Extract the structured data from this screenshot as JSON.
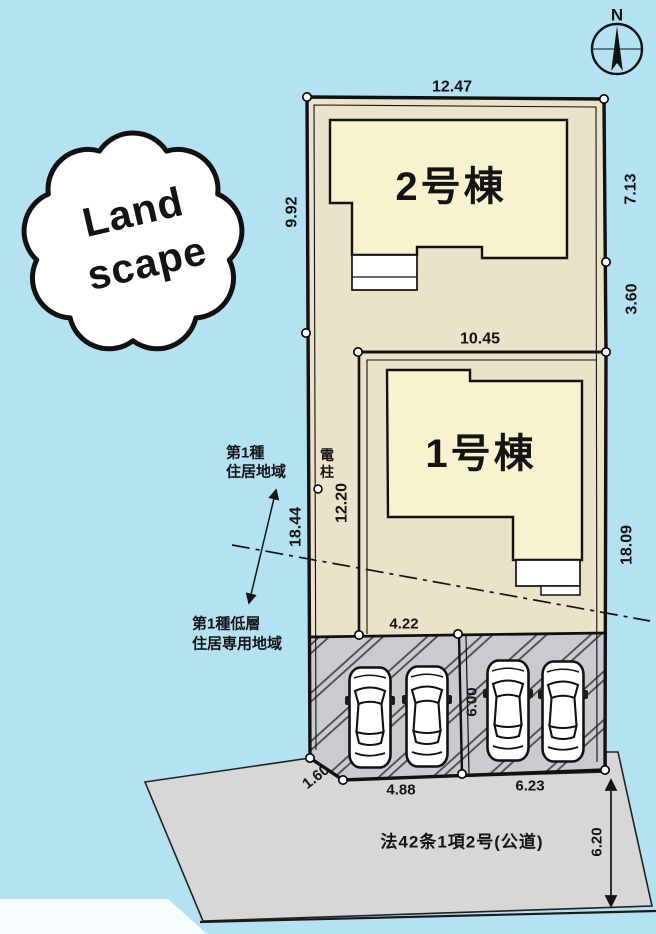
{
  "compass": {
    "north": "N"
  },
  "stamp": {
    "line1": "Land",
    "line2": "scape"
  },
  "buildings": {
    "b2": "2号棟",
    "b1": "1号棟"
  },
  "dims": {
    "top_width": "12.47",
    "left_upper": "9.92",
    "right_upper": "7.13",
    "right_mid": "3.60",
    "parcel1_top": "10.45",
    "parcel1_left": "12.20",
    "left_lower": "18.44",
    "right_lower": "18.09",
    "parcel1_bottom": "4.22",
    "parking_depth": "6.00",
    "corner_cut": "1.60",
    "parking_left_width": "4.88",
    "parking_right_width": "6.23",
    "road_width": "6.20"
  },
  "zoning": {
    "zone1_line1": "第1種",
    "zone1_line2": "住居地域",
    "zone2_line1": "第1種低層",
    "zone2_line2": "住居専用地域"
  },
  "pole": {
    "char1": "電",
    "char2": "柱"
  },
  "road": {
    "label": "法42条1項2号(公道)"
  },
  "colors": {
    "background": "#b5e2f2",
    "land": "#ebe2ca",
    "building": "#f9f2cf",
    "parking": "#cbcbcf",
    "road": "#d7d7d8"
  }
}
